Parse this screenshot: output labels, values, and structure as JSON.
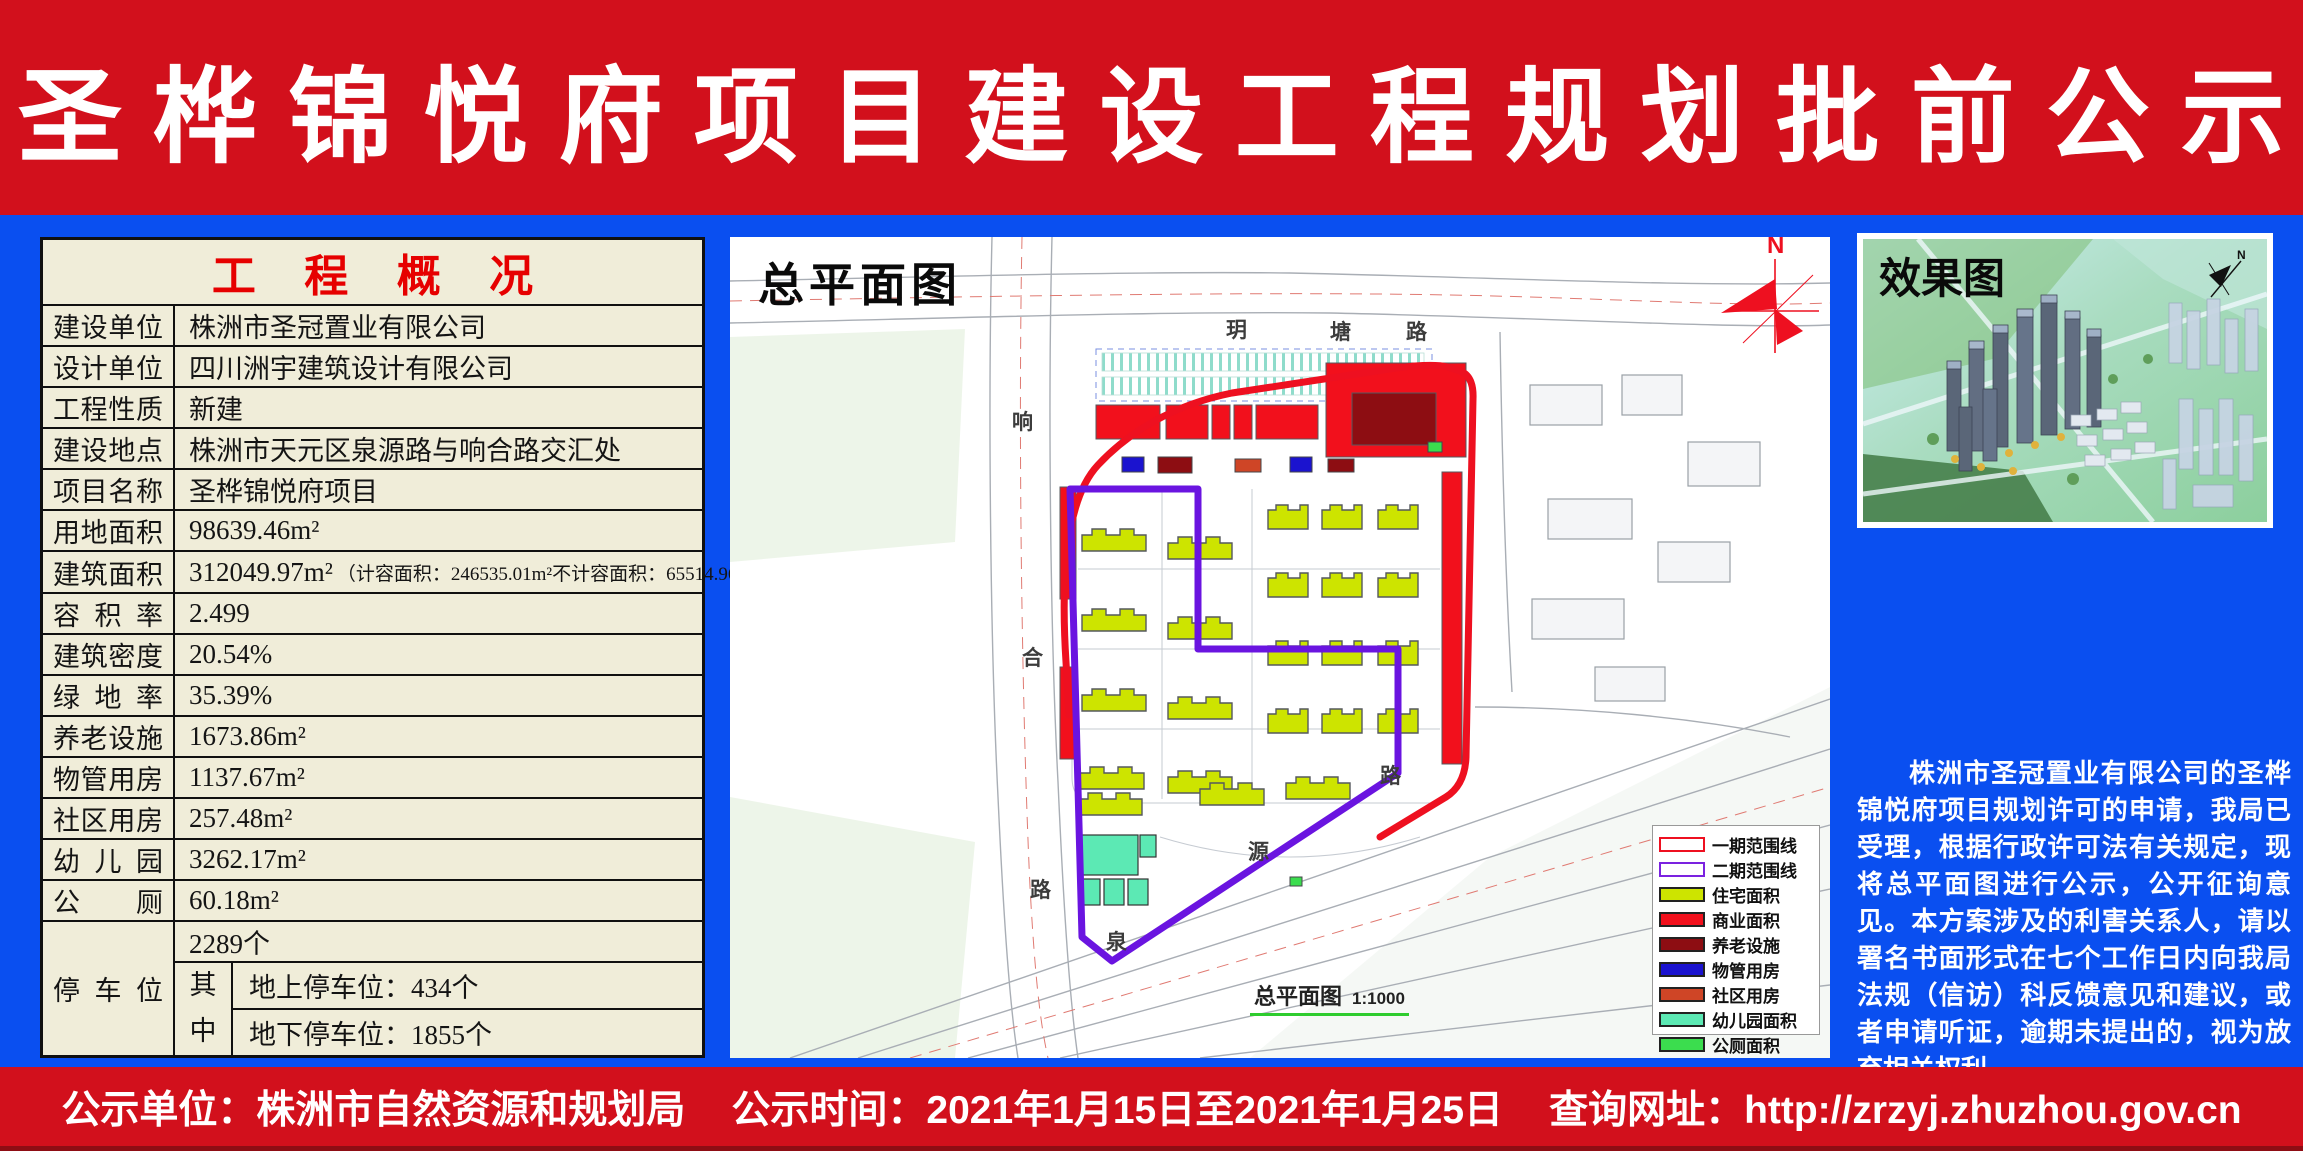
{
  "title": "圣桦锦悦府项目建设工程规划批前公示",
  "overview_table": {
    "header": "工程概况",
    "rows": [
      {
        "label": "建设单位",
        "value": "株洲市圣冠置业有限公司"
      },
      {
        "label": "设计单位",
        "value": "四川洲宇建筑设计有限公司"
      },
      {
        "label": "工程性质",
        "value": "新建"
      },
      {
        "label": "建设地点",
        "value": "株洲市天元区泉源路与响合路交汇处"
      },
      {
        "label": "项目名称",
        "value": "圣桦锦悦府项目"
      },
      {
        "label": "用地面积",
        "value": "98639.46m²"
      },
      {
        "label": "建筑面积",
        "value": "312049.97m²",
        "note": "（计容面积：246535.01m²不计容面积：65514.96m²）"
      },
      {
        "label": "容积率",
        "value": "2.499"
      },
      {
        "label": "建筑密度",
        "value": "20.54%"
      },
      {
        "label": "绿地率",
        "value": "35.39%"
      },
      {
        "label": "养老设施",
        "value": "1673.86m²"
      },
      {
        "label": "物管用房",
        "value": "1137.67m²"
      },
      {
        "label": "社区用房",
        "value": "257.48m²"
      },
      {
        "label": "幼儿园",
        "value": "3262.17m²"
      },
      {
        "label": "公厕",
        "value": "60.18m²"
      }
    ],
    "parking": {
      "label": "停车位",
      "total": "2289个",
      "sub_label": "其中",
      "above": "地上停车位：434个",
      "below": "地下停车位：1855个"
    }
  },
  "site_plan": {
    "title": "总平面图",
    "scale_label": "总平面图",
    "scale_value": "1:1000",
    "north_label": "N",
    "road_labels": {
      "top": [
        "玥",
        "塘",
        "路"
      ],
      "left": [
        "响",
        "合",
        "路"
      ],
      "diagonal": [
        "泉",
        "源",
        "路"
      ]
    },
    "legend": [
      {
        "label": "一期范围线",
        "fill": "#ffffff",
        "border": "#ee1020"
      },
      {
        "label": "二期范围线",
        "fill": "#ffffff",
        "border": "#7b22e0"
      },
      {
        "label": "住宅面积",
        "fill": "#cde400",
        "border": "#222222"
      },
      {
        "label": "商业面积",
        "fill": "#f2101c",
        "border": "#222222"
      },
      {
        "label": "养老设施",
        "fill": "#8d0d12",
        "border": "#222222"
      },
      {
        "label": "物管用房",
        "fill": "#1b13cf",
        "border": "#222222"
      },
      {
        "label": "社区用房",
        "fill": "#cf4526",
        "border": "#222222"
      },
      {
        "label": "幼儿园面积",
        "fill": "#5ce9b4",
        "border": "#222222"
      },
      {
        "label": "公厕面积",
        "fill": "#3bdd4e",
        "border": "#222222"
      }
    ]
  },
  "right_panel": {
    "render_title": "效果图",
    "north_label": "N",
    "notice": "株洲市圣冠置业有限公司的圣桦锦悦府项目规划许可的申请，我局已受理，根据行政许可法有关规定，现将总平面图进行公示，公开征询意见。本方案涉及的利害关系人，请以署名书面形式在七个工作日内向我局法规（信访）科反馈意见和建议，或者申请听证，逾期未提出的，视为放弃相关权利。",
    "phone_label": "投诉电话：28689359",
    "agency": "株洲市自然资源和规划局",
    "date": "2021年1月15日"
  },
  "footer": {
    "unit": "公示单位：株洲市自然资源和规划局",
    "time": "公示时间：2021年1月15日至2021年1月25日",
    "url": "查询网址：http://zrzyj.zhuzhou.gov.cn"
  },
  "colors": {
    "banner_red": "#d2101c",
    "background_blue": "#0a4ff0",
    "table_background": "#f0edd9",
    "table_title_red": "#e60000",
    "phase1_line": "#ee1020",
    "phase2_line": "#6a14e0"
  }
}
